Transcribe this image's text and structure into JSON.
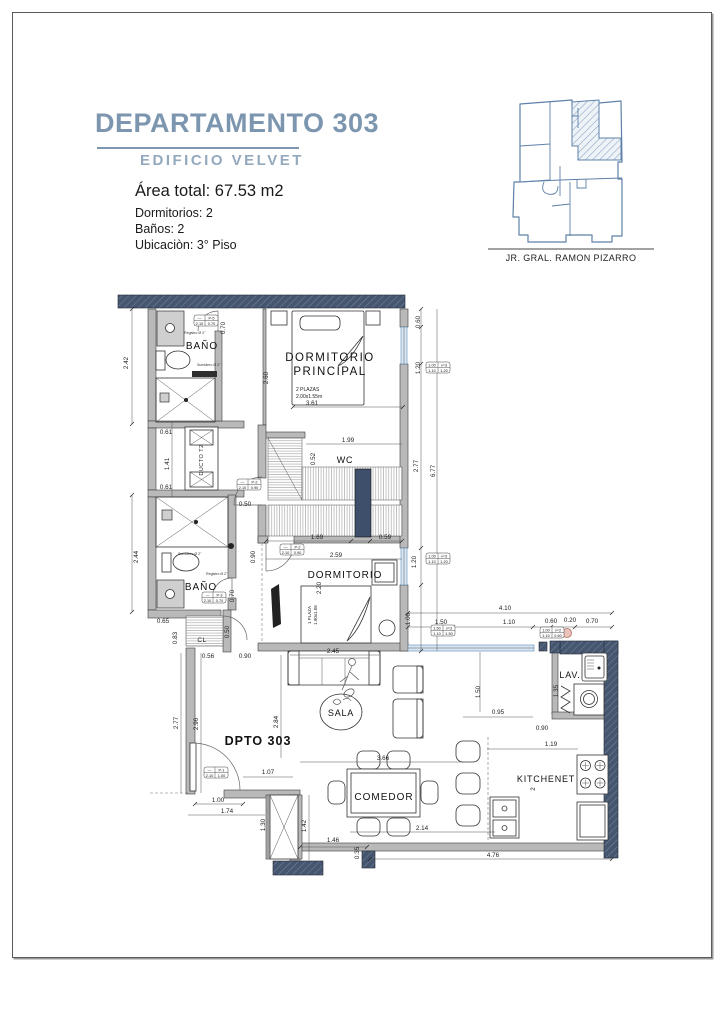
{
  "header": {
    "title": "DEPARTAMENTO 303",
    "subtitle": "EDIFICIO VELVET",
    "area": "Área total: 67.53 m2",
    "dormitorios": "Dormitorios: 2",
    "banos": "Baños: 2",
    "ubicacion": "Ubicaciòn: 3° Piso",
    "map_caption": "JR. GRAL. RAMON PIZARRO"
  },
  "rooms": {
    "bano1": "BAÑO",
    "dorm_p1": "DORMITORIO",
    "dorm_p2": "PRINCIPAL",
    "bed_p_spec1": "2 PLAZAS",
    "bed_p_spec2": "2.00x1.55m",
    "wc": "WC",
    "ducto": "DUCTO T2",
    "bano2": "BAÑO",
    "dormitorio": "DORMITORIO",
    "bed_s_spec1": "1 PLAZA",
    "bed_s_spec2": "1.90x1.05",
    "cl": "CL",
    "sala": "SALA",
    "dpto": "DPTO  303",
    "comedor": "COMEDOR",
    "kitchenet": "KITCHENET",
    "lav": "LAV."
  },
  "fixtures": {
    "registro": "Registro Ø 2\"",
    "sumidero": "Sumidero Ø 2\""
  },
  "specs": {
    "p5": {
      "a": "—",
      "b": "P-5",
      "c": "2.10",
      "d": "0.70"
    },
    "p2a": {
      "a": "—",
      "b": "P-2",
      "c": "2.10",
      "d": "0.90"
    },
    "p2b": {
      "a": "—",
      "b": "P-2",
      "c": "2.10",
      "d": "0.90"
    },
    "p3": {
      "a": "—",
      "b": "P-3",
      "c": "2.10",
      "d": "0.70"
    },
    "p1": {
      "a": "—",
      "b": "P-1",
      "c": "2.10",
      "d": "1.00"
    },
    "v3a": {
      "a": "1.00",
      "b": "v=3",
      "c": "1.10",
      "d": "1.20"
    },
    "v3b": {
      "a": "1.00",
      "b": "v=3",
      "c": "1.10",
      "d": "1.20"
    },
    "v3c": {
      "a": "1.50",
      "b": "v=3",
      "c": "1.10",
      "d": "1.50"
    },
    "v2": {
      "a": "1.00",
      "b": "v=2",
      "c": "1.10",
      "d": "0.60"
    }
  },
  "dims": [
    "2.42",
    "0.70",
    "2.60",
    "0.60",
    "1.20",
    "3.61",
    "1.99",
    "0.52",
    "2.77",
    "6.77",
    "0.61",
    "1.41",
    "0.61",
    "0.50",
    "1.69",
    "0.59",
    "0.90",
    "2.59",
    "2.20",
    "1.20",
    "1.00",
    "2.44",
    "0.70",
    "0.65",
    "0.83",
    "0.50",
    "0.56",
    "0.90",
    "2.77",
    "2.96",
    "2.84",
    "2.45",
    "4.10",
    "1.50",
    "1.10",
    "0.60",
    "0.20",
    "0.70",
    "1.50",
    "1.35",
    "0.95",
    "0.90",
    "1.19",
    "3.66",
    "1.07",
    "1.00",
    "1.74",
    "1.30",
    "1.42",
    "1.46",
    "2.14",
    "4.76",
    "0.35",
    "2"
  ],
  "colors": {
    "accent_blue": "#7d96b0",
    "wall_dark": "#46566e",
    "window_blue": "#5b8ab8"
  }
}
